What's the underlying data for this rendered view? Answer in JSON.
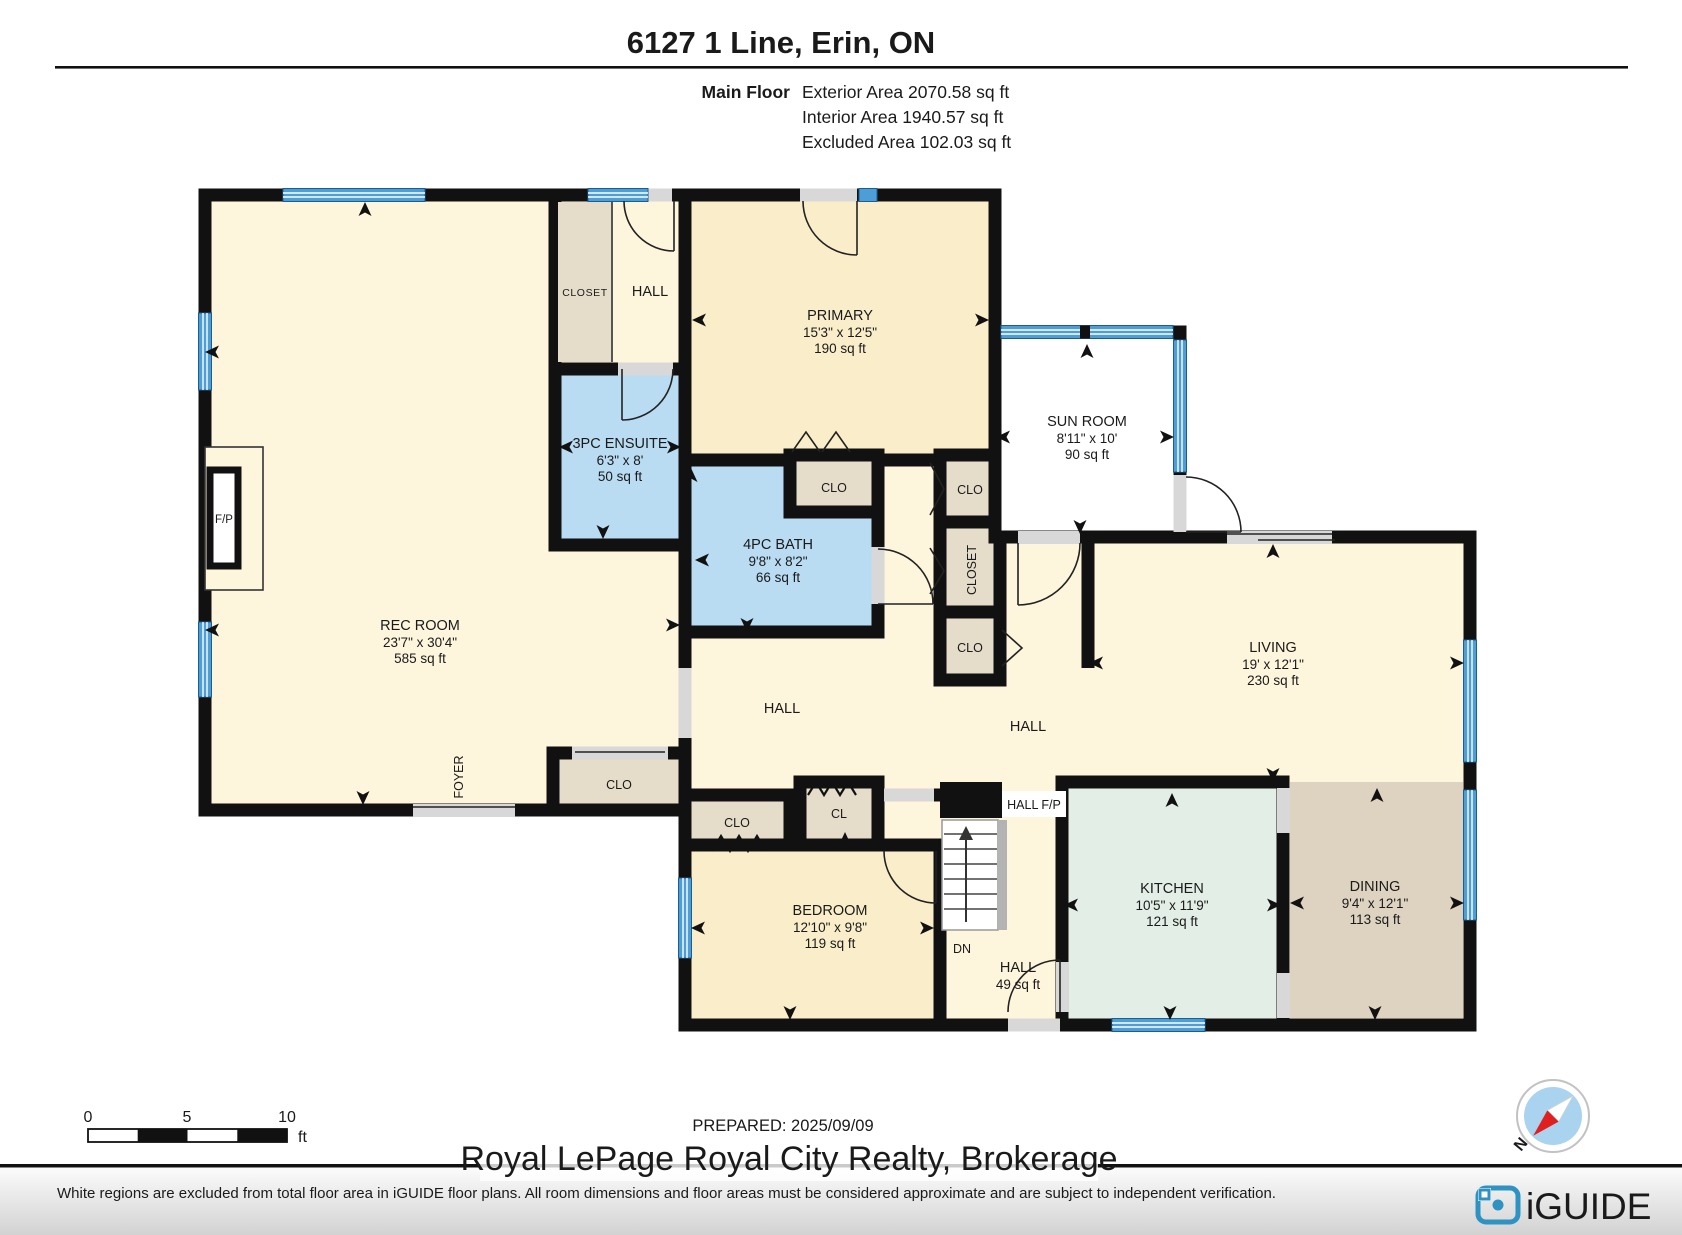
{
  "header": {
    "title": "6127 1 Line, Erin, ON",
    "floor_label": "Main Floor",
    "area_lines": [
      "Exterior Area 2070.58 sq ft",
      "Interior Area 1940.57 sq ft",
      "Excluded Area 102.03 sq ft"
    ]
  },
  "rooms": {
    "rec_room": {
      "name": "REC ROOM",
      "dims": "23'7\" x 30'4\"",
      "area": "585 sq ft"
    },
    "primary": {
      "name": "PRIMARY",
      "dims": "15'3\" x 12'5\"",
      "area": "190 sq ft"
    },
    "ensuite": {
      "name": "3PC ENSUITE",
      "dims": "6'3\" x 8'",
      "area": "50 sq ft"
    },
    "bath": {
      "name": "4PC BATH",
      "dims": "9'8\" x 8'2\"",
      "area": "66 sq ft"
    },
    "sun_room": {
      "name": "SUN ROOM",
      "dims": "8'11\" x 10'",
      "area": "90 sq ft"
    },
    "living": {
      "name": "LIVING",
      "dims": "19' x 12'1\"",
      "area": "230 sq ft"
    },
    "kitchen": {
      "name": "KITCHEN",
      "dims": "10'5\" x 11'9\"",
      "area": "121 sq ft"
    },
    "dining": {
      "name": "DINING",
      "dims": "9'4\" x 12'1\"",
      "area": "113 sq ft"
    },
    "bedroom": {
      "name": "BEDROOM",
      "dims": "12'10\" x 9'8\"",
      "area": "119 sq ft"
    },
    "hall_lower": {
      "name": "HALL",
      "area": "49 sq ft"
    }
  },
  "labels": {
    "closet": "CLOSET",
    "hall": "HALL",
    "clo": "CLO",
    "cl": "CL",
    "foyer": "FOYER",
    "fp": "F/P",
    "hall_fp": "HALL F/P",
    "dn": "DN"
  },
  "scale_bar": {
    "ticks": [
      "0",
      "5",
      "10"
    ],
    "unit": "ft"
  },
  "footer": {
    "prepared": "PREPARED: 2025/09/09",
    "watermark": "Royal LePage Royal City Realty, Brokerage",
    "disclaimer": "White regions are excluded from total floor area in iGUIDE floor plans. All room dimensions and floor areas must be considered approximate and are subject to independent verification.",
    "brand": "iGUIDE",
    "compass_north": "N"
  },
  "colors": {
    "wall": "#111111",
    "room_cream": "#fdf5dc",
    "room_gold": "#faeeca",
    "closet_beige": "#e5ddca",
    "bath_blue": "#b9dcf2",
    "kitchen_mint": "#e3eee7",
    "dining_tan": "#ded3c1",
    "window_blue": "#4d9ed6",
    "door_gray": "#d8d8d8",
    "brand_blue": "#2e93c3",
    "compass_red": "#e02020"
  }
}
